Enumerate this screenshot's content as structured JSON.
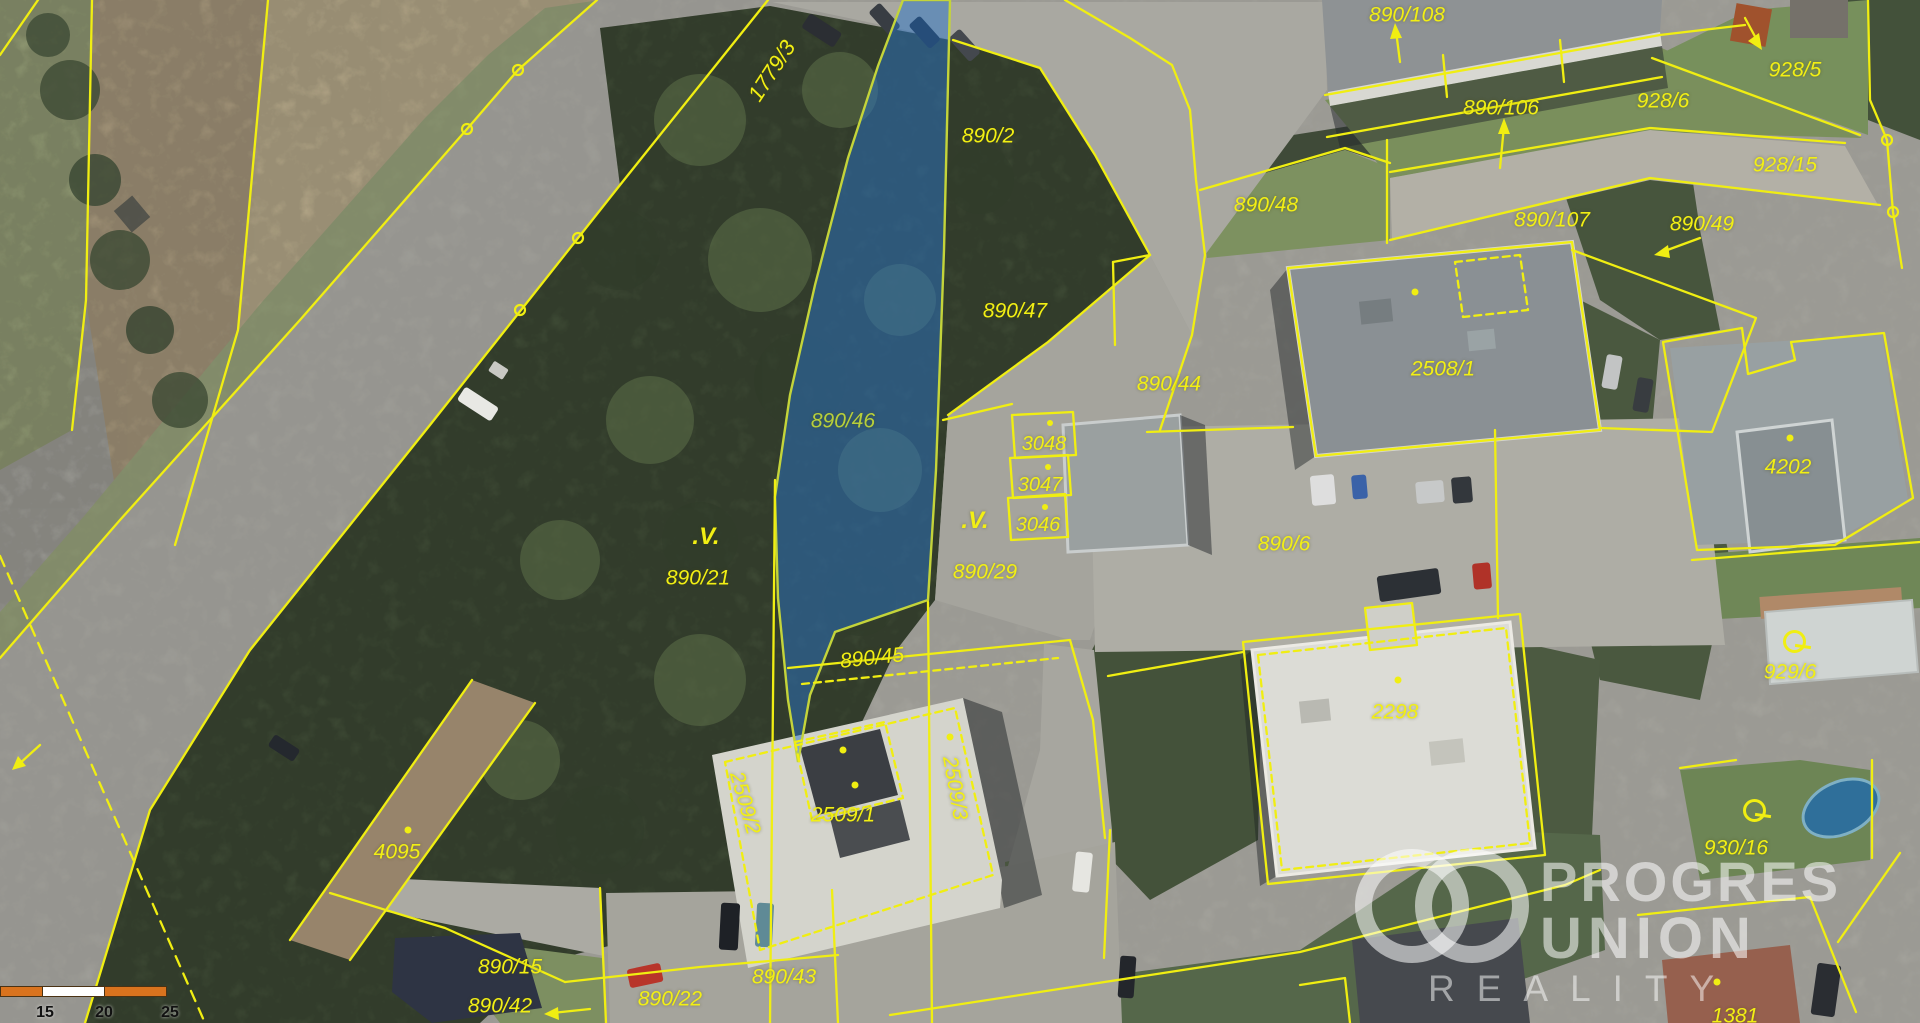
{
  "app": {
    "type": "cadastral-aerial-map",
    "highlighted_parcel": "890/46"
  },
  "colors": {
    "parcel-line": "#f0ee12",
    "label": "#f2ef14",
    "highlight-fill": "rgba(42,116,200,0.50)",
    "highlight-stroke": "#c4d43a",
    "watermark": "rgba(255,255,255,0.55)",
    "scale-orange": "#d9731e",
    "scale-white": "#ffffff"
  },
  "map": {
    "labels": [
      {
        "t": "1779/3",
        "x": 772,
        "y": 71,
        "r": -57,
        "s": 22
      },
      {
        "t": "890/2",
        "x": 988,
        "y": 136,
        "s": 21
      },
      {
        "t": "890/108",
        "x": 1407,
        "y": 15,
        "s": 21
      },
      {
        "t": "890/106",
        "x": 1501,
        "y": 108,
        "s": 21
      },
      {
        "t": "928/5",
        "x": 1795,
        "y": 70,
        "s": 21
      },
      {
        "t": "928/6",
        "x": 1663,
        "y": 101,
        "s": 21
      },
      {
        "t": "928/15",
        "x": 1785,
        "y": 165,
        "s": 21
      },
      {
        "t": "890/107",
        "x": 1552,
        "y": 220,
        "s": 21
      },
      {
        "t": "890/49",
        "x": 1702,
        "y": 224,
        "s": 21
      },
      {
        "t": "890/48",
        "x": 1266,
        "y": 205,
        "s": 21
      },
      {
        "t": "890/47",
        "x": 1015,
        "y": 311,
        "s": 21
      },
      {
        "t": "890/44",
        "x": 1169,
        "y": 384,
        "s": 21
      },
      {
        "t": "2508/1",
        "x": 1443,
        "y": 369,
        "s": 21
      },
      {
        "t": "890/46",
        "x": 843,
        "y": 421,
        "s": 21,
        "c": "#b8cf3a"
      },
      {
        "t": "3048",
        "x": 1044,
        "y": 444,
        "s": 20
      },
      {
        "t": "3047",
        "x": 1040,
        "y": 485,
        "s": 20
      },
      {
        "t": "3046",
        "x": 1038,
        "y": 525,
        "s": 20
      },
      {
        "t": ".V.",
        "x": 706,
        "y": 537,
        "s": 24,
        "b": 1
      },
      {
        "t": ".V.",
        "x": 975,
        "y": 521,
        "s": 24,
        "b": 1
      },
      {
        "t": "890/21",
        "x": 698,
        "y": 578,
        "s": 21
      },
      {
        "t": "890/29",
        "x": 985,
        "y": 572,
        "s": 21
      },
      {
        "t": "890/6",
        "x": 1284,
        "y": 544,
        "s": 21
      },
      {
        "t": "890/45",
        "x": 872,
        "y": 658,
        "s": 21,
        "r": -6
      },
      {
        "t": "4202",
        "x": 1788,
        "y": 467,
        "s": 21
      },
      {
        "t": "929/6",
        "x": 1790,
        "y": 672,
        "s": 21
      },
      {
        "t": "2298",
        "x": 1395,
        "y": 712,
        "s": 21
      },
      {
        "t": "2509/2",
        "x": 745,
        "y": 803,
        "s": 21,
        "r": 74
      },
      {
        "t": "2509/1",
        "x": 843,
        "y": 815,
        "s": 21
      },
      {
        "t": "2509/3",
        "x": 955,
        "y": 788,
        "s": 21,
        "r": 80
      },
      {
        "t": "4095",
        "x": 397,
        "y": 852,
        "s": 21
      },
      {
        "t": "930/16",
        "x": 1736,
        "y": 848,
        "s": 21
      },
      {
        "t": "890/15",
        "x": 510,
        "y": 967,
        "s": 21
      },
      {
        "t": "890/42",
        "x": 500,
        "y": 1006,
        "s": 21
      },
      {
        "t": "890/22",
        "x": 670,
        "y": 999,
        "s": 21
      },
      {
        "t": "890/43",
        "x": 784,
        "y": 977,
        "s": 21
      },
      {
        "t": "1381",
        "x": 1735,
        "y": 1016,
        "s": 21
      }
    ],
    "symbols": [
      {
        "type": "circle-tail",
        "x": 1793,
        "y": 640
      },
      {
        "type": "circle-tail",
        "x": 1753,
        "y": 809
      }
    ]
  },
  "watermark": {
    "brand_top": "PROGRES",
    "brand_bottom": "UNION",
    "tagline": "REALITY"
  },
  "scale_bar": {
    "ticks": [
      "15",
      "20",
      "25 m"
    ]
  }
}
